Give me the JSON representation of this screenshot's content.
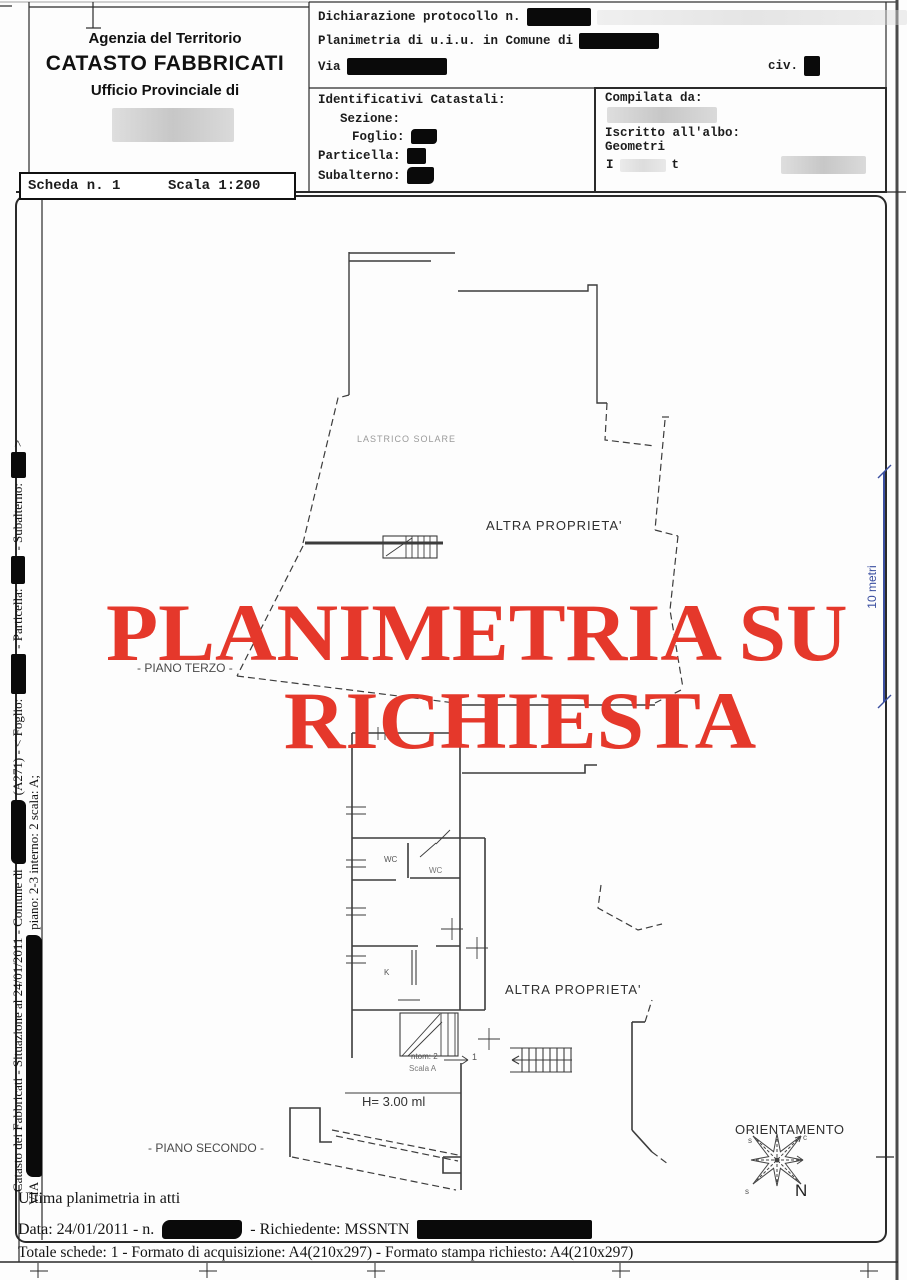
{
  "page_title": "Catasto Fabbricati - Planimetria",
  "colors": {
    "stamp_red": "#e5382b",
    "dimension_blue": "#3b4fa0"
  },
  "header": {
    "agency": {
      "line1": "Agenzia del Territorio",
      "line2": "CATASTO FABBRICATI",
      "line3": "Ufficio Provinciale di"
    },
    "declaration": {
      "protocol": "Dichiarazione protocollo n.",
      "planimetria": "Planimetria di u.i.u. in Comune di",
      "via": "Via",
      "civ": "civ."
    },
    "identifiers": {
      "title": "Identificativi Catastali:",
      "sezione": "Sezione:",
      "foglio": "Foglio:",
      "particella": "Particella:",
      "subalterno": "Subalterno:"
    },
    "compiler": {
      "title": "Compilata da:",
      "albo1": "Iscritto all'albo:",
      "albo2": "Geometri",
      "partial1": "I",
      "partial2": "t"
    },
    "scheda": {
      "number": "Scheda n. 1",
      "scale": "Scala 1:200"
    }
  },
  "stamp": {
    "line1": "PLANIMETRIA SU",
    "line2": "RICHIESTA"
  },
  "plan": {
    "lastrico_solare": "LASTRICO SOLARE",
    "altra_proprieta_top": "ALTRA PROPRIETA'",
    "altra_proprieta_bottom": "ALTRA PROPRIETA'",
    "piano_terzo": "- PIANO TERZO -",
    "piano_secondo": "- PIANO SECONDO -",
    "wc1": "WC",
    "wc2": "WC",
    "kitchen": "K",
    "stair_note1": "ntom: 2",
    "stair_note2": "Scala A",
    "stair_arrow_label": "1",
    "height_note": "H= 3.00 ml"
  },
  "compass": {
    "title": "ORIENTAMENTO",
    "north": "N",
    "tip_top_left": "s",
    "tip_top_right": "c",
    "tip_bottom_left": "s"
  },
  "scale_bar": {
    "label": "10 metri"
  },
  "sidebar": {
    "line1_a": "Catasto dei Fabbricati - Situazione al 24/01/2011 - Comune di",
    "line1_b": "(A271) - < Foglio:",
    "line1_c": "- Particella:",
    "line1_d": "- Subalterno:",
    "line1_e": ">",
    "line2_a": "VIA",
    "line2_b": "piano: 2-3 interno: 2 scala: A;"
  },
  "footer": {
    "ultima": "Ultima planimetria in atti",
    "data_a": "Data: 24/01/2011 - n.",
    "data_b": "- Richiedente: MSSNTN",
    "totale": "Totale schede: 1 - Formato di acquisizione: A4(210x297) - Formato stampa richiesto: A4(210x297)"
  }
}
